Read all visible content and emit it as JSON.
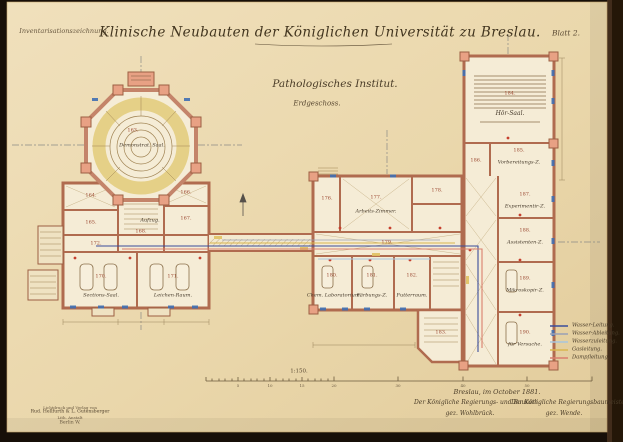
{
  "sheet": {
    "annotation_top_left": "Inventarisationszeichnung.",
    "title": "Klinische Neubauten der Königlichen Universität zu Breslau.",
    "sheet_number": "Blatt 2.",
    "subtitle": "Pathologisches Institut.",
    "floor_label": "Erdgeschoss."
  },
  "plan_left": {
    "building_name": "Demonstrationsgebäude",
    "rooms": [
      {
        "number": "163.",
        "label": "Demonstrat. Saal."
      },
      {
        "number": "164."
      },
      {
        "number": "165."
      },
      {
        "number": "166."
      },
      {
        "number": "167."
      },
      {
        "number": "168.",
        "label": "Aufzug."
      },
      {
        "number": "172."
      },
      {
        "number": "170.",
        "label": "Sections-Saal."
      },
      {
        "number": "171.",
        "label": "Leichen-Raum."
      }
    ]
  },
  "plan_right": {
    "building_name": "Institutsgebäude",
    "rooms": [
      {
        "number": "176."
      },
      {
        "number": "177.",
        "label": "Arbeits-Zimmer."
      },
      {
        "number": "178."
      },
      {
        "number": "179."
      },
      {
        "number": "180.",
        "label": "Chem. Laboratorium."
      },
      {
        "number": "181.",
        "label": "Färbungs-Z."
      },
      {
        "number": "182.",
        "label": "Futterraum."
      },
      {
        "number": "183."
      },
      {
        "number": "184.",
        "label": "Hör-Saal."
      },
      {
        "number": "185.",
        "label": "Vorbereitungs-Z."
      },
      {
        "number": "186."
      },
      {
        "number": "187.",
        "label": "Experimentir-Z."
      },
      {
        "number": "188.",
        "label": "Assistenten-Z."
      },
      {
        "number": "189.",
        "label": "Mikroskopir-Z."
      },
      {
        "number": "190.",
        "label": "für Versuche."
      }
    ]
  },
  "legend": {
    "entries": [
      {
        "label": "Wasser-Leitung.",
        "color": "#3b4d9a"
      },
      {
        "label": "Wasser-Ableitung.",
        "color": "#9aa0b5"
      },
      {
        "label": "Wasserzuleitung.",
        "color": "#a8c6dd"
      },
      {
        "label": "Gasleitung.",
        "color": "#d9b64f"
      },
      {
        "label": "Dampfleitung.",
        "color": "#d97f6d"
      }
    ]
  },
  "scale": {
    "ratio": "1:150.",
    "tick_labels": [
      "5",
      "10",
      "15",
      "20",
      "30",
      "40",
      "50"
    ]
  },
  "footer": {
    "place_date": "Breslau, im October 1881.",
    "left_official": "Der Königliche Regierungs- und Baurath.",
    "left_signature": "gez. Wohlbrück.",
    "right_official": "Der Königliche Regierungsbaumeister.",
    "right_signature": "gez. Wende.",
    "imprint_lines": [
      "Lichtdruck und Verlag von",
      "Rud. Hellfurth & L. Gutensberger",
      "Lith. Anstalt",
      "Berlin W."
    ]
  },
  "colors": {
    "paper": "#ecd9ae",
    "wall_poche": "#e8a184",
    "water": "#3b4d9a",
    "drain": "#9aa0b5",
    "supply": "#a8c6dd",
    "gas": "#d9b64f",
    "steam": "#d97f6d"
  }
}
